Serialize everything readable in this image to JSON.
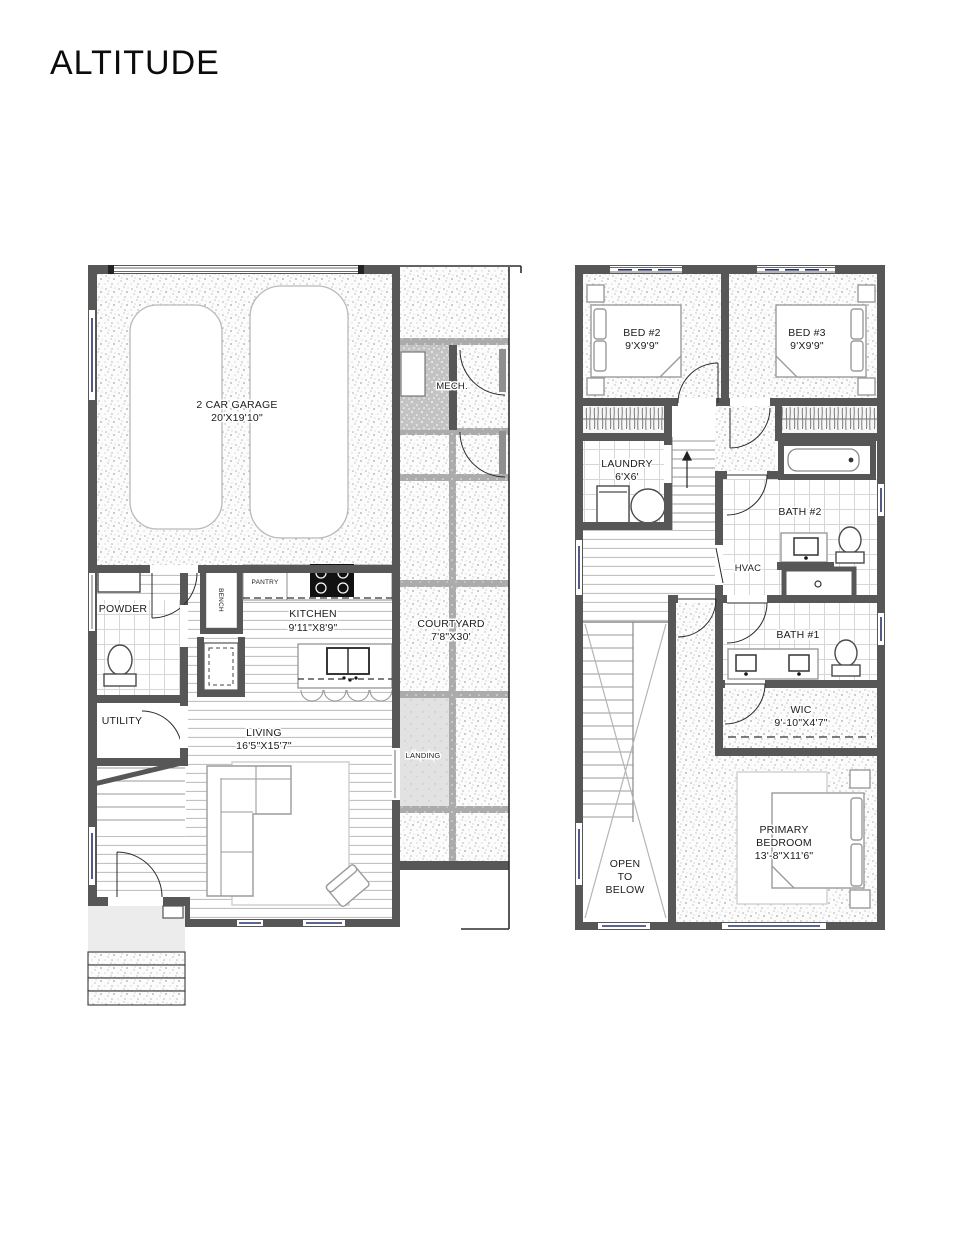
{
  "title": "ALTITUDE",
  "floor1": {
    "garage_name": "2 CAR GARAGE",
    "garage_dims": "20'X19'10\"",
    "mech": "MECH.",
    "powder": "POWDER",
    "utility": "UTILITY",
    "pantry": "PANTRY",
    "bench": "BENCH",
    "kitchen_name": "KITCHEN",
    "kitchen_dims": "9'11\"X8'9\"",
    "living_name": "LIVING",
    "living_dims": "16'5\"X15'7\"",
    "courtyard_name": "COURTYARD",
    "courtyard_dims": "7'8\"X30'",
    "landing": "LANDING"
  },
  "floor2": {
    "bed2_name": "BED #2",
    "bed2_dims": "9'X9'9\"",
    "bed3_name": "BED #3",
    "bed3_dims": "9'X9'9\"",
    "laundry_name": "LAUNDRY",
    "laundry_dims": "6'X6'",
    "bath2": "BATH #2",
    "hvac": "HVAC",
    "bath1": "BATH #1",
    "wic_name": "WIC",
    "wic_dims": "9'-10\"X4'7\"",
    "primary_line1": "PRIMARY",
    "primary_line2": "BEDROOM",
    "primary_dims": "13'-8\"X11'6\"",
    "open_line1": "OPEN",
    "open_line2": "TO",
    "open_line3": "BELOW"
  }
}
